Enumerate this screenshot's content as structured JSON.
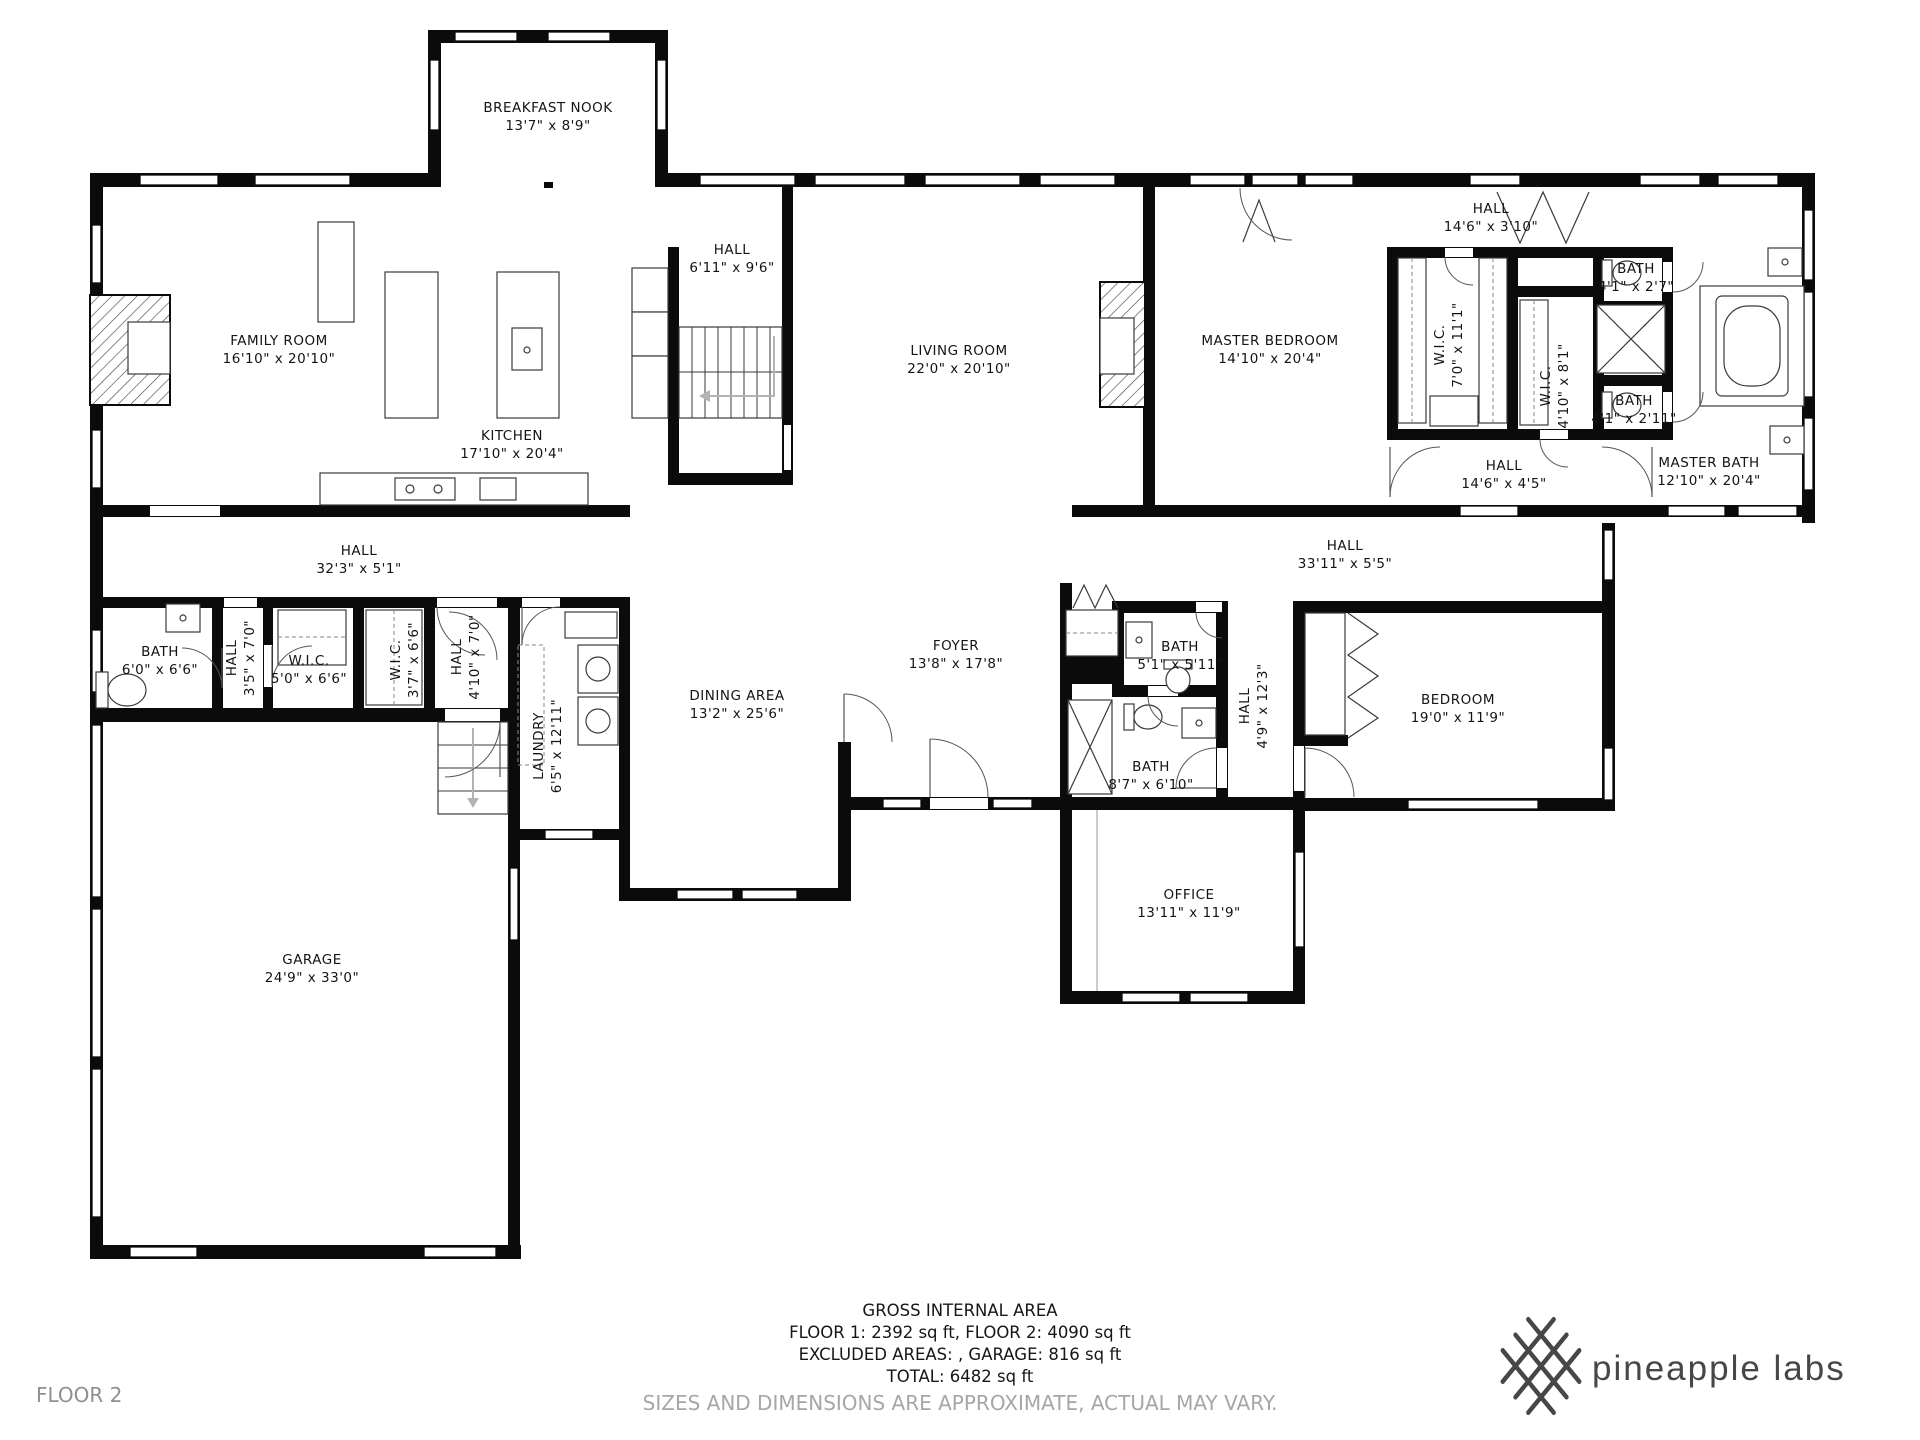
{
  "floor_label": "FLOOR 2",
  "branding": {
    "logo_icon": "pineapple-lattice-icon",
    "name": "pineapple labs"
  },
  "summary": {
    "title": "GROSS INTERNAL AREA",
    "line1": "FLOOR 1: 2392 sq ft, FLOOR 2: 4090 sq ft",
    "line2": "EXCLUDED AREAS: , GARAGE: 816 sq ft",
    "line3": "TOTAL: 6482 sq ft",
    "disclaimer": "SIZES AND DIMENSIONS ARE APPROXIMATE, ACTUAL MAY VARY."
  },
  "rooms": {
    "breakfast_nook": {
      "name": "BREAKFAST NOOK",
      "dims": "13'7\" x 8'9\""
    },
    "family_room": {
      "name": "FAMILY ROOM",
      "dims": "16'10\" x 20'10\""
    },
    "kitchen": {
      "name": "KITCHEN",
      "dims": "17'10\" x 20'4\""
    },
    "hall_upper": {
      "name": "HALL",
      "dims": "6'11\" x 9'6\""
    },
    "living_room": {
      "name": "LIVING ROOM",
      "dims": "22'0\" x 20'10\""
    },
    "master_bedroom": {
      "name": "MASTER BEDROOM",
      "dims": "14'10\" x 20'4\""
    },
    "hall_top_right": {
      "name": "HALL",
      "dims": "14'6\" x 3'10\""
    },
    "wic_master_1": {
      "name": "W.I.C.",
      "dims": "7'0\" x 11'1\""
    },
    "wic_master_2": {
      "name": "W.I.C.",
      "dims": "4'10\" x 8'1\""
    },
    "bath_small_1": {
      "name": "BATH",
      "dims": "4'1\" x 2'7\""
    },
    "bath_small_2": {
      "name": "BATH",
      "dims": "4'1\" x 2'11\""
    },
    "master_bath": {
      "name": "MASTER BATH",
      "dims": "12'10\" x 20'4\""
    },
    "hall_master": {
      "name": "HALL",
      "dims": "14'6\" x 4'5\""
    },
    "hall_left": {
      "name": "HALL",
      "dims": "32'3\" x 5'1\""
    },
    "hall_right": {
      "name": "HALL",
      "dims": "33'11\" x 5'5\""
    },
    "bath_left": {
      "name": "BATH",
      "dims": "6'0\" x 6'6\""
    },
    "hall_35": {
      "name": "HALL",
      "dims": "3'5\" x 7'0\""
    },
    "wic_50": {
      "name": "W.I.C.",
      "dims": "5'0\" x 6'6\""
    },
    "wic_37": {
      "name": "W.I.C.",
      "dims": "3'7\" x 6'6\""
    },
    "hall_410": {
      "name": "HALL",
      "dims": "4'10\" x 7'0\""
    },
    "laundry": {
      "name": "LAUNDRY",
      "dims": "6'5\" x 12'11\""
    },
    "dining_area": {
      "name": "DINING AREA",
      "dims": "13'2\" x 25'6\""
    },
    "foyer": {
      "name": "FOYER",
      "dims": "13'8\" x 17'8\""
    },
    "bath_51": {
      "name": "BATH",
      "dims": "5'1\" x 5'11\""
    },
    "bath_87": {
      "name": "BATH",
      "dims": "8'7\" x 6'10\""
    },
    "hall_49": {
      "name": "HALL",
      "dims": "4'9\" x 12'3\""
    },
    "bedroom": {
      "name": "BEDROOM",
      "dims": "19'0\" x 11'9\""
    },
    "office": {
      "name": "OFFICE",
      "dims": "13'11\" x 11'9\""
    },
    "garage": {
      "name": "GARAGE",
      "dims": "24'9\" x 33'0\""
    }
  }
}
